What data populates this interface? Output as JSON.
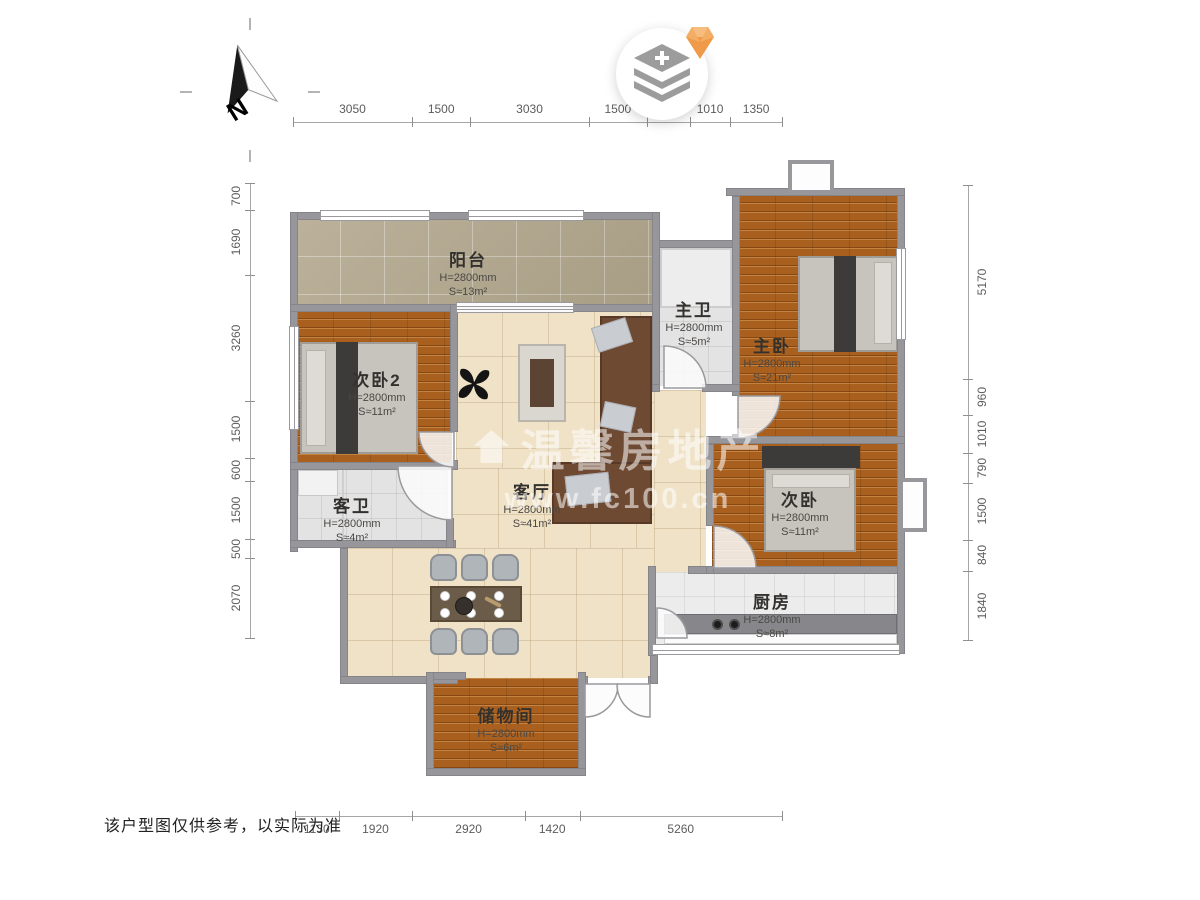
{
  "page": {
    "disclaimer": "该户型图仅供参考，以实际为准"
  },
  "compass": {
    "label": "N"
  },
  "watermark": {
    "line1": "温馨房地产",
    "line2": "www.fc100.cn"
  },
  "rooms": [
    {
      "id": "balcony",
      "name": "阳台",
      "height": "H=2800mm",
      "area": "S≈13m²"
    },
    {
      "id": "bedroom2",
      "name": "次卧2",
      "height": "H=2800mm",
      "area": "S≈11m²"
    },
    {
      "id": "guest-bath",
      "name": "客卫",
      "height": "H=2800mm",
      "area": "S≈4m²"
    },
    {
      "id": "living-room",
      "name": "客厅",
      "height": "H=2800mm",
      "area": "S≈41m²"
    },
    {
      "id": "master-bath",
      "name": "主卫",
      "height": "H=2800mm",
      "area": "S≈5m²"
    },
    {
      "id": "master-bedroom",
      "name": "主卧",
      "height": "H=2800mm",
      "area": "S≈21m²"
    },
    {
      "id": "second-bedroom",
      "name": "次卧",
      "height": "H=2800mm",
      "area": "S≈11m²"
    },
    {
      "id": "kitchen",
      "name": "厨房",
      "height": "H=2800mm",
      "area": "S≈8m²"
    },
    {
      "id": "storage",
      "name": "储物间",
      "height": "H=2800mm",
      "area": "S≈6m²"
    }
  ],
  "dimensions": {
    "top": [
      3050,
      1500,
      3030,
      1500,
      1110,
      1010,
      1350
    ],
    "bottom": [
      1130,
      1920,
      2920,
      1420,
      5260
    ],
    "left": [
      700,
      1690,
      3260,
      1500,
      600,
      1500,
      500,
      2070
    ],
    "right": [
      5170,
      960,
      1010,
      790,
      1500,
      840,
      1840
    ]
  }
}
